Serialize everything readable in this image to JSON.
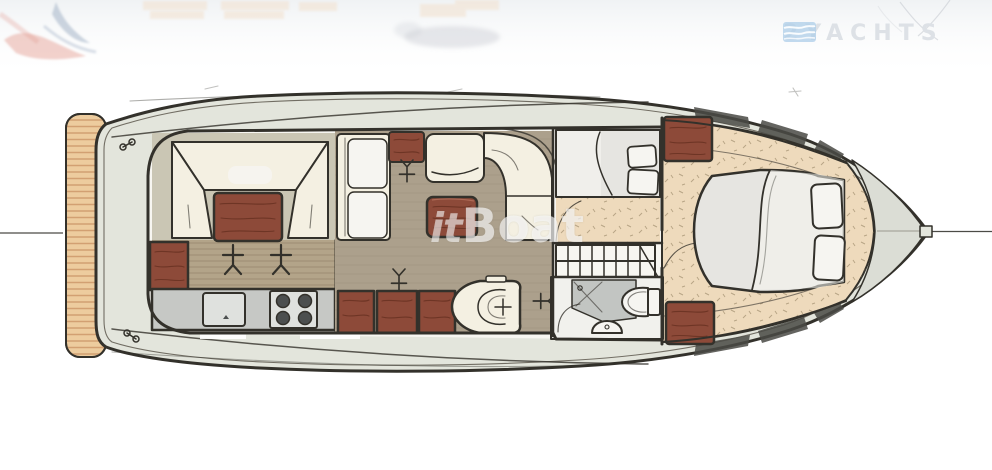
{
  "page": {
    "width": 992,
    "height": 470,
    "background": "#ffffff"
  },
  "banner": {
    "logo_text": "2YACHTS",
    "logo_icon": "striped-flag-icon",
    "decor": [
      "red-blue-paint-swirl",
      "faded-peach-blocks",
      "faded-gray-blob",
      "faint-pencil-sketch-lines"
    ]
  },
  "watermark": {
    "italic_part": "it",
    "bold_part": "Boat"
  },
  "floorplan": {
    "subject": "motor-yacht-interior-deck-plan",
    "orientation": "bow-right-stern-left",
    "rooms": [
      "swim-platform",
      "cockpit-dinette",
      "galley",
      "salon",
      "guest-cabin",
      "companionway-stairs",
      "head",
      "forward-master-cabin",
      "bow-deck"
    ]
  },
  "colors": {
    "outline": "#33312b",
    "deck": "#e3e5dc",
    "deck_line": "#716d63",
    "platform": "#edcc9e",
    "platform_line": "#d2a072",
    "interior_bg": "#f7f6f1",
    "floor_olive": "#cac6b4",
    "floor_taupe": "#aca08c",
    "floor_taupe_line": "#93846f",
    "wood_floor": "#b3a489",
    "wood_line": "#8a7a60",
    "cream": "#f4f0e2",
    "red_wood": "#8d4a39",
    "red_wood_dark": "#662f20",
    "counter_gray": "#c6c8c5",
    "counter_light": "#dfe1de",
    "burner": "#4c4f4f",
    "bed_gray": "#e6e5e1",
    "pillow": "#f6f5f1",
    "tan_carpet": "#eedabc",
    "tan_speckle": "#82704f",
    "head_floor": "#f1f1ed",
    "shower_gray": "#c2c5c2",
    "bow_gray": "#dbddd5",
    "hatch_dark": "#4a4a45",
    "watermark": "rgba(250,250,250,0.65)",
    "logo_text": "#dde1e6",
    "logo_blue": "#aecde8",
    "banner_peach": "#f2dfca",
    "banner_red": "#e2998f",
    "banner_blue": "#93a3bd",
    "banner_gray": "#c9cdd3",
    "centerline": "#4c4b46"
  }
}
